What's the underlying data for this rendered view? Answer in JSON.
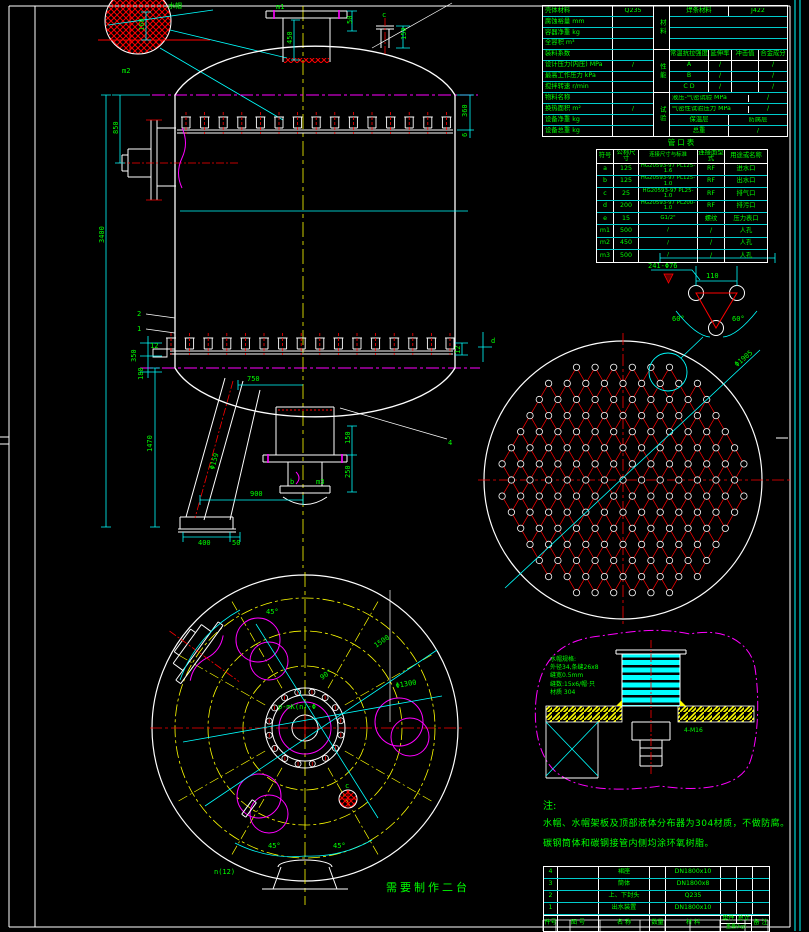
{
  "labels": {
    "callout_water_cap": "水帽",
    "m1": "m1",
    "m2": "m2",
    "m3": "m3",
    "b": "b",
    "c": "c",
    "d": "d",
    "dim_450": "450",
    "dim_50": "50",
    "dim_150_top": "150",
    "dim_360": "360",
    "dim_6": "6",
    "dim_160": "160",
    "dim_850": "850",
    "dim_3400": "3400",
    "dim_12_left": "12",
    "dim_350": "350",
    "dim_180": "180",
    "dim_12_right": "12",
    "part_1": "1",
    "part_2": "2",
    "part_4": "4",
    "dim_750": "750",
    "dim_1470": "1470",
    "dim_leg": "Φ159",
    "dim_900": "900",
    "dim_400": "400",
    "dim_50_base": "50",
    "dim_150_flange": "150",
    "dim_250": "250",
    "dim_tubesheet": "Φ1905",
    "dim_pitch": "110",
    "dim_60_left": "60°",
    "dim_60_right": "60°",
    "tube_holes": "241-Φ76",
    "plan_45_top": "45°",
    "plan_45_bl": "45°",
    "plan_45_br": "45°",
    "plan_90": "90°",
    "plan_1500": "1500",
    "plan_phi1300": "Φ1300",
    "plan_n12": "n(12)",
    "plan_center_note": "p-mK(n)-Φ",
    "plan_c": "c",
    "make_note": "需要制作二台"
  },
  "spec_table": {
    "left_rows": [
      [
        "壳体材料",
        "Q235"
      ],
      [
        "腐蚀裕量 mm",
        ""
      ],
      [
        "容器净重 kg",
        ""
      ],
      [
        "全容积 m³",
        ""
      ],
      [
        "装料系数",
        ""
      ],
      [
        "设计压力(内压) MPa",
        "/"
      ],
      [
        "最高工作压力 kPa",
        ""
      ],
      [
        "搅拌转速 r/min",
        ""
      ],
      [
        "物料名称",
        ""
      ],
      [
        "换热面积 m²",
        "/"
      ],
      [
        "设备净重 kg",
        ""
      ],
      [
        "设备总重 kg",
        ""
      ]
    ],
    "v_strips": [
      "材料",
      "性能",
      "试验"
    ],
    "weld": {
      "label": "焊条材料",
      "value": "J422"
    },
    "mech_headers": [
      "常温抗拉强度",
      "延伸率",
      "冲击值",
      "合金成分"
    ],
    "mech_rows": [
      [
        "A",
        "/",
        "",
        "/"
      ],
      [
        "B",
        "/",
        "",
        "/"
      ],
      [
        "C D",
        "/",
        "",
        "/"
      ]
    ],
    "tests": [
      [
        "液压-气密试验 MPa",
        "/"
      ],
      [
        "气密性试验压力 MPa",
        "/"
      ]
    ],
    "coat": [
      "保温层",
      "防腐层"
    ],
    "bottom": [
      "总重",
      "/"
    ]
  },
  "nozzle_table": {
    "title": "管口表",
    "headers": [
      "符号",
      "公称尺寸",
      "连接尺寸与标准",
      "连接面型式",
      "用途或名称"
    ],
    "rows": [
      [
        "a",
        "125",
        "HG20593-97 PL125-1.6",
        "RF",
        "进水口"
      ],
      [
        "b",
        "125",
        "HG20593-97 PL125-1.0",
        "RF",
        "出水口"
      ],
      [
        "c",
        "25",
        "HG20593-97 PL25-1.0",
        "RF",
        "排气口"
      ],
      [
        "d",
        "200",
        "HG20593-97 PL200-1.0",
        "RF",
        "排污口"
      ],
      [
        "e",
        "15",
        "G1/2\"",
        "螺纹",
        "压力表口"
      ],
      [
        "m1",
        "500",
        "/",
        "/",
        "人孔"
      ],
      [
        "m2",
        "450",
        "/",
        "/",
        "人孔"
      ],
      [
        "m3",
        "500",
        "/",
        "/",
        "人孔"
      ]
    ]
  },
  "notes": {
    "title": "注:",
    "lines": [
      "水帽、水帽架板及顶部液体分布器为304材质，不做防腐。",
      "碳钢筒体和碳钢接管内侧均涂环氧树脂。"
    ]
  },
  "detail": {
    "spec_lines": [
      "水帽规格:",
      "外径34,条缝26x8",
      "缝宽0.5mm",
      "缝数:15x6/帽·只",
      "材质 304"
    ],
    "label_right": "4-M16"
  },
  "parts_list": {
    "headers": {
      "no": "件号",
      "drawing": "图 号",
      "name": "名 称",
      "qty": "数量",
      "material": "材 料",
      "single": "单件",
      "total": "总计",
      "weight": "重量(kg)",
      "remark": "备 注"
    },
    "rows": [
      {
        "no": "4",
        "drawing": "",
        "name": "裙座",
        "qty": "",
        "material": "DN1800x10",
        "single": "",
        "total": "",
        "remark": ""
      },
      {
        "no": "3",
        "drawing": "",
        "name": "筒体",
        "qty": "",
        "material": "DN1800x8",
        "single": "",
        "total": "",
        "remark": ""
      },
      {
        "no": "2",
        "drawing": "",
        "name": "上、下封头",
        "qty": "",
        "material": "Q235",
        "single": "",
        "total": "",
        "remark": ""
      },
      {
        "no": "1",
        "drawing": "",
        "name": "出水装置",
        "qty": "",
        "material": "DN1800x10",
        "single": "",
        "total": "",
        "remark": ""
      }
    ]
  }
}
